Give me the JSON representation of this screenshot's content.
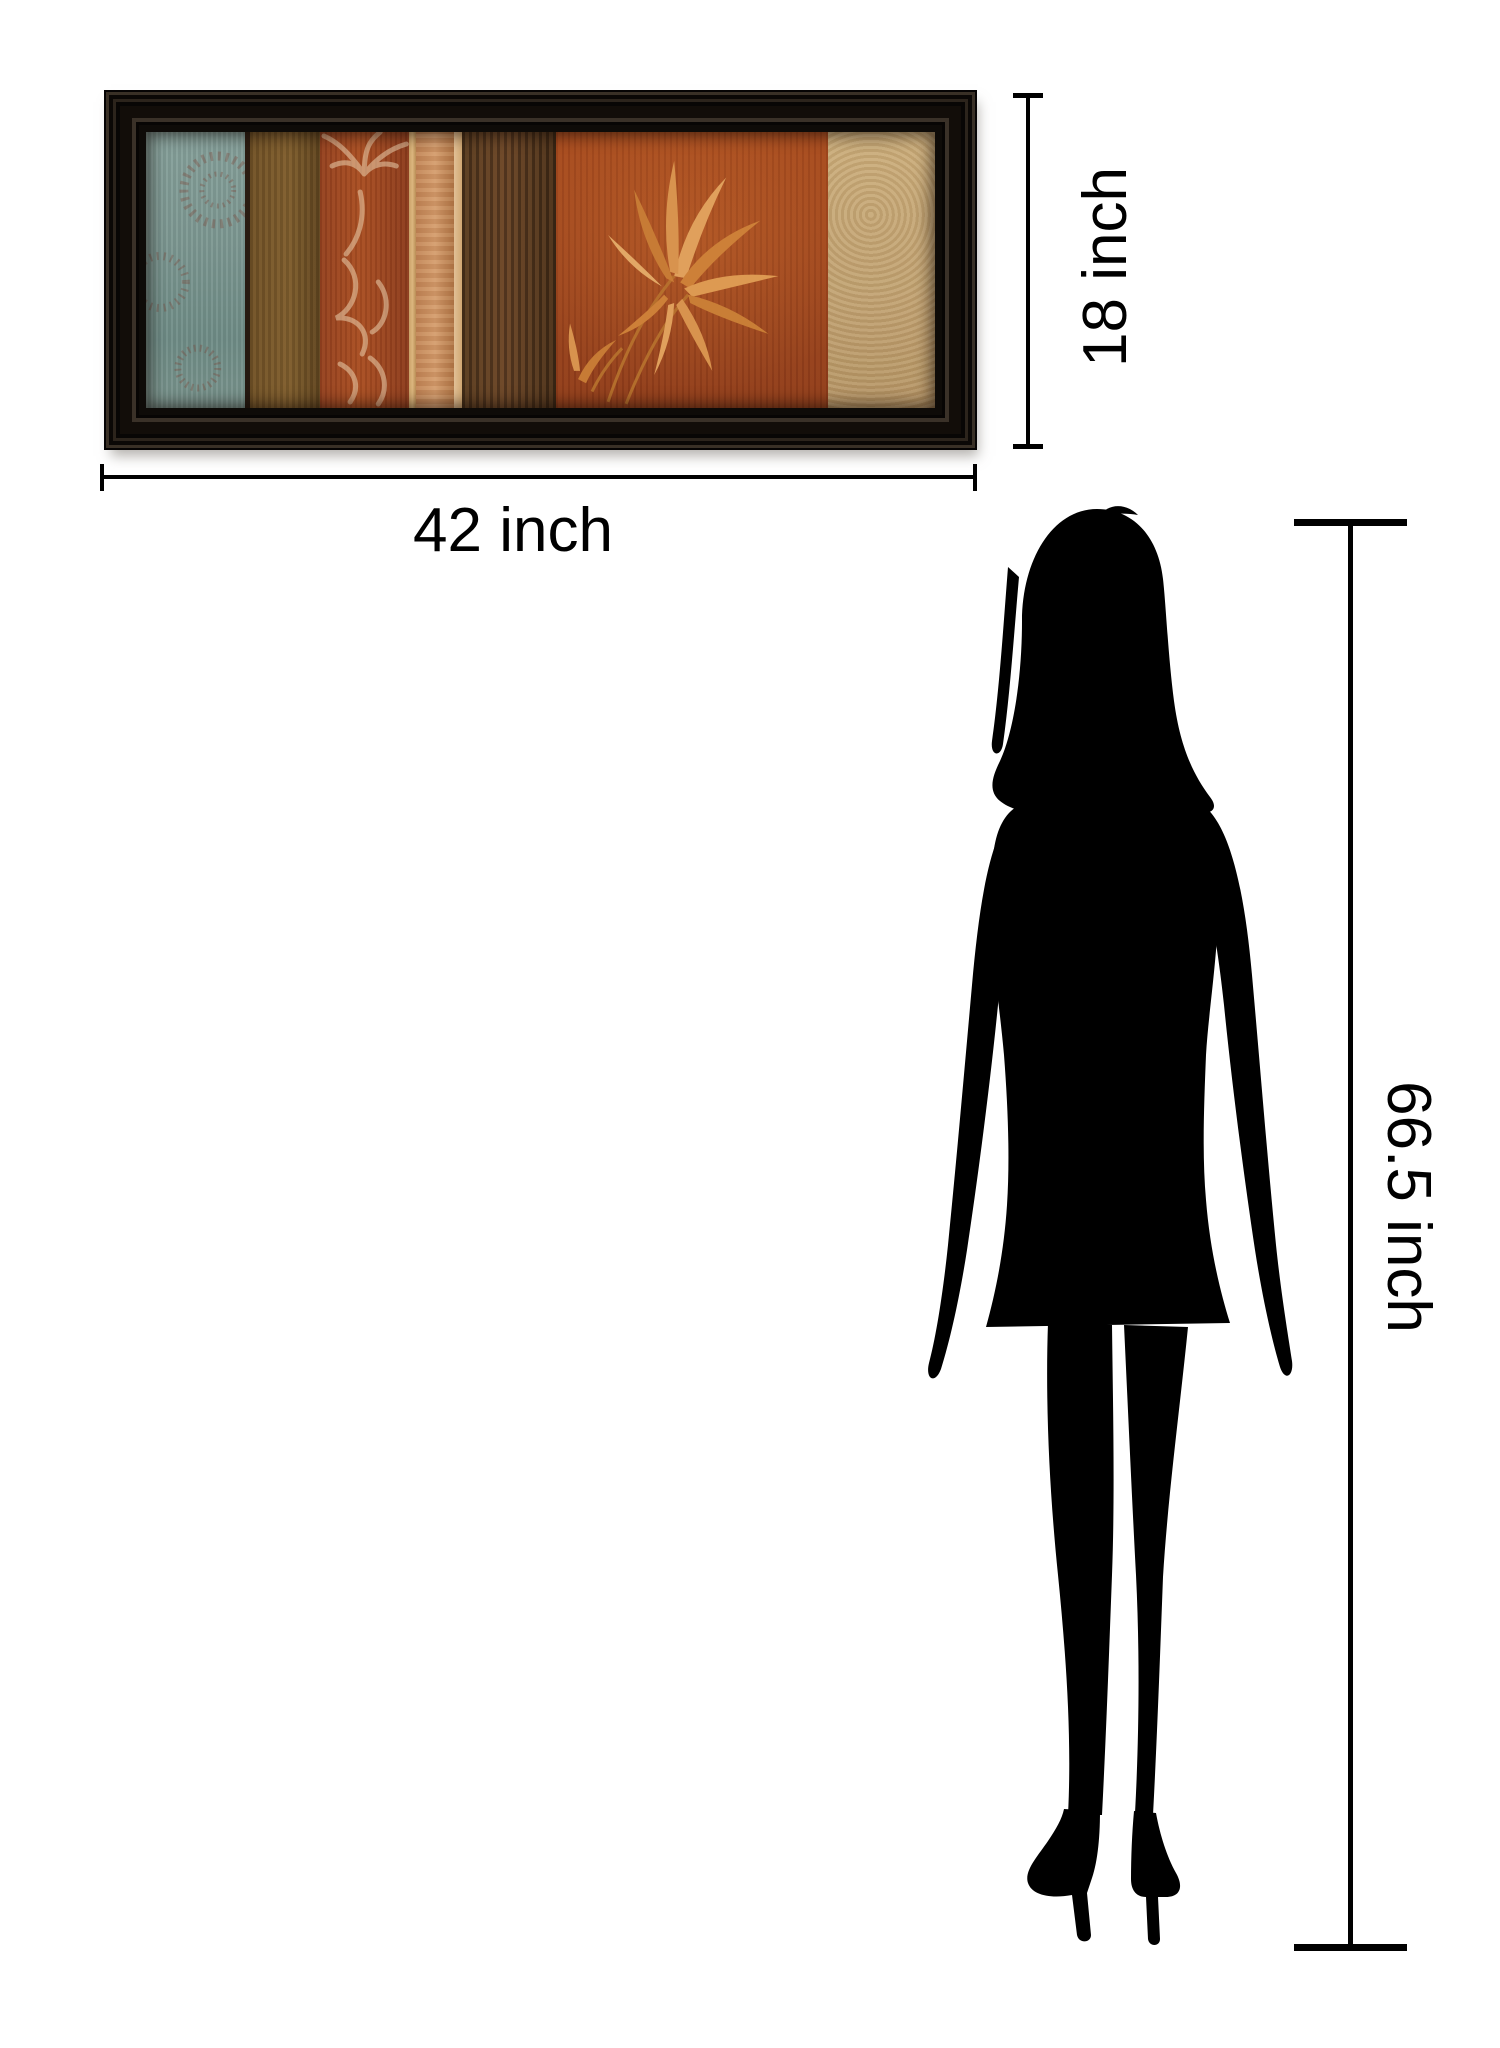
{
  "page": {
    "background_color": "#ffffff"
  },
  "product": {
    "name": "framed panel wall art",
    "frame_color": "#0e0b08",
    "art_palette": [
      "#7c9791",
      "#6f5026",
      "#a84d22",
      "#d49c6c",
      "#53381e",
      "#9c431c",
      "#c9ab79"
    ],
    "leaf_color": "#d8934e"
  },
  "person": {
    "name": "standing woman silhouette",
    "color": "#000000"
  },
  "dimensions": {
    "line_color": "#000000",
    "art_width": {
      "label": "42 inch"
    },
    "art_height": {
      "label": "18 inch"
    },
    "person_height": {
      "label": "66.5 inch"
    }
  }
}
